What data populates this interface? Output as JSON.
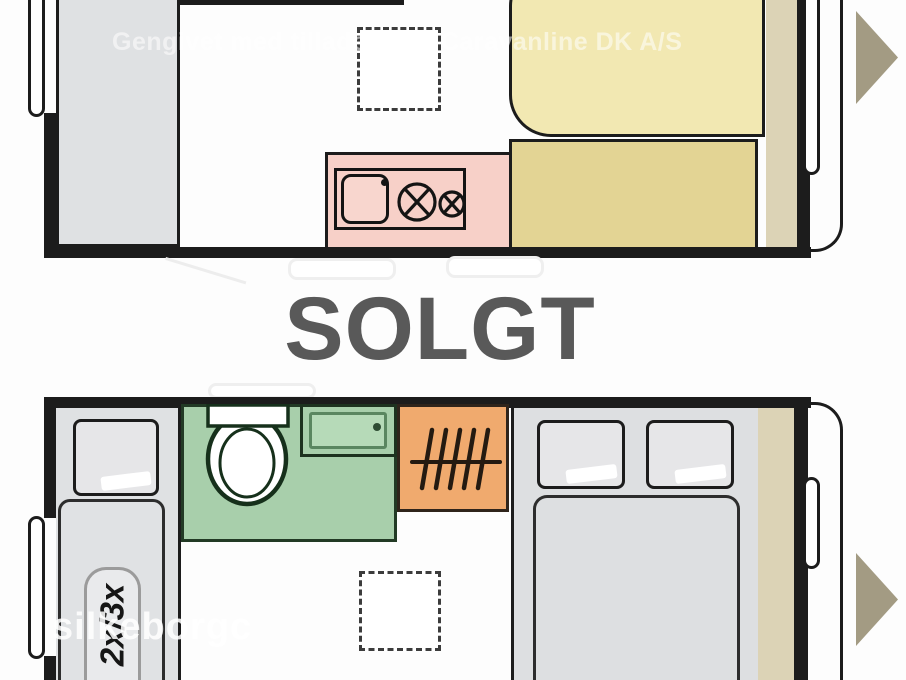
{
  "meta": {
    "type": "caravan-floorplan-sales-image",
    "image_width": 906,
    "image_height": 680
  },
  "sold_overlay": {
    "label": "SOLGT",
    "color": "#595959"
  },
  "watermarks": {
    "top": "Gengivet med tilladelse af Caravanline DK A/S",
    "bottom": "silkeborgc"
  },
  "plan_top": {
    "name": "floorplan-front-section",
    "rooms": [
      {
        "name": "wardrobe-cabinet",
        "color": "#dfe1e3"
      },
      {
        "name": "entry-door",
        "side": "left"
      },
      {
        "name": "roof-skylight",
        "style": "dashed-square"
      },
      {
        "name": "kitchen-counter",
        "color": "#f7d0c8",
        "features": [
          "sink",
          "faucet",
          "large-burner",
          "small-burner"
        ]
      },
      {
        "name": "dinette-seat",
        "color": "#f2e8b2"
      },
      {
        "name": "dinette-table",
        "color": "#e3d494"
      },
      {
        "name": "side-shelf",
        "color": "#dcd3b6"
      },
      {
        "name": "drawbar-arrow",
        "color": "#a39b83",
        "direction": "right"
      }
    ]
  },
  "plan_bottom": {
    "name": "floorplan-rear-section",
    "bunk_label": "2x/3x",
    "rooms": [
      {
        "name": "bunk-bed",
        "color": "#dfe1e3",
        "features": [
          "pillow",
          "capacity-label"
        ]
      },
      {
        "name": "entry-door",
        "side": "left"
      },
      {
        "name": "bathroom",
        "color": "#a8cfab",
        "features": [
          "toilet",
          "washbasin"
        ]
      },
      {
        "name": "wardrobe",
        "color": "#f0aa6e",
        "features": [
          "clothes-rail"
        ]
      },
      {
        "name": "double-bed",
        "color": "#dddfe1",
        "features": [
          "pillow",
          "pillow"
        ]
      },
      {
        "name": "roof-skylight",
        "style": "dashed-square"
      },
      {
        "name": "side-shelf",
        "color": "#dcd3b6"
      },
      {
        "name": "drawbar-arrow",
        "color": "#a39b83",
        "direction": "right"
      }
    ]
  }
}
